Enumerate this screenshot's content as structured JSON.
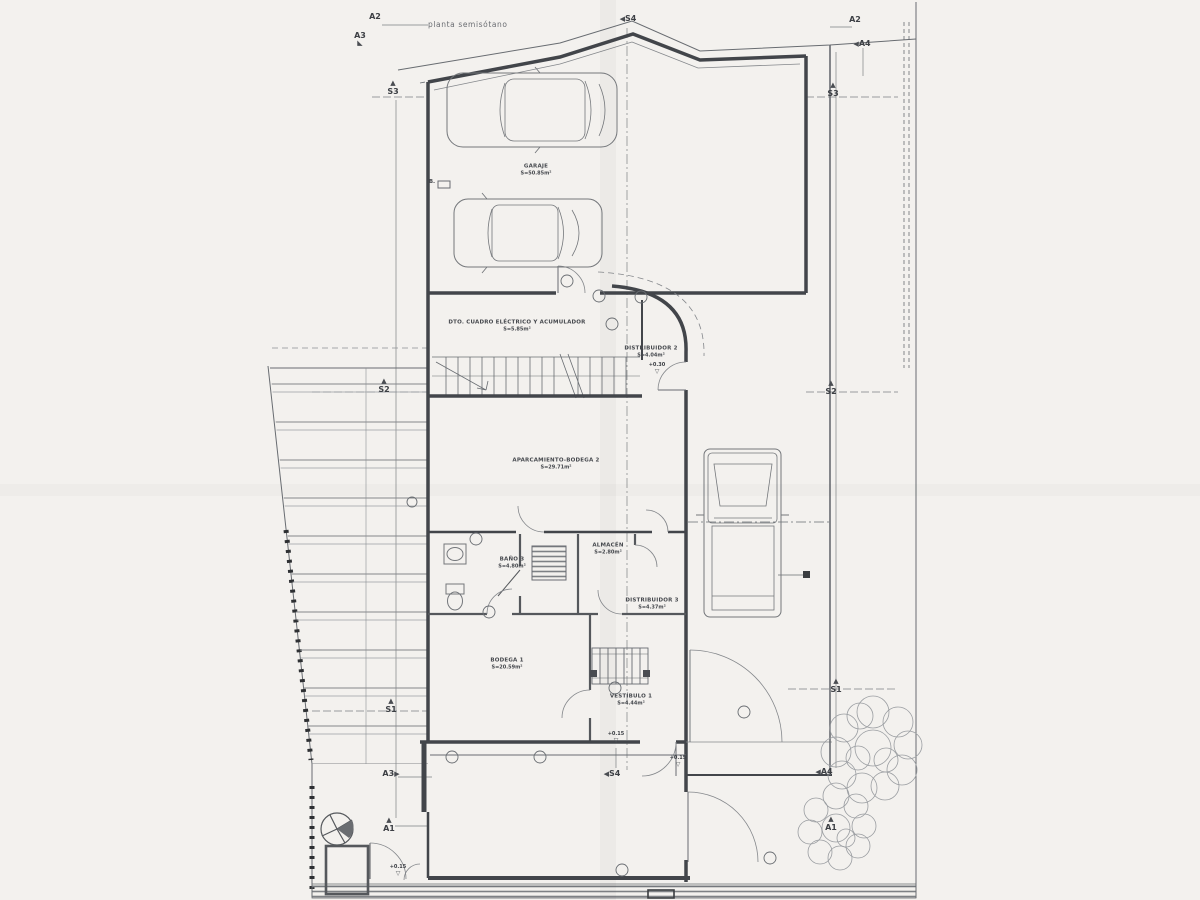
{
  "meta": {
    "title": "planta semisótano"
  },
  "colors": {
    "paper": "#f3f1ee",
    "line": "#686c71",
    "wall": "#42454a",
    "dark": "#2b2d30"
  },
  "rooms": [
    {
      "name": "GARAJE",
      "area": "S=50.85m²",
      "x": 536,
      "y": 170
    },
    {
      "name": "DTO. CUADRO ELÉCTRICO Y ACUMULADOR",
      "area": "S=5.85m²",
      "x": 517,
      "y": 326
    },
    {
      "name": "DISTRIBUIDOR 2",
      "area": "S=4.04m²",
      "x": 651,
      "y": 352
    },
    {
      "name": "APARCAMIENTO-BODEGA 2",
      "area": "S=29.71m²",
      "x": 556,
      "y": 464
    },
    {
      "name": "BAÑO 3",
      "area": "S=4.80m²",
      "x": 512,
      "y": 563
    },
    {
      "name": "ALMACÉN",
      "area": "S=2.80m²",
      "x": 608,
      "y": 549
    },
    {
      "name": "DISTRIBUIDOR 3",
      "area": "S=4.37m²",
      "x": 652,
      "y": 604
    },
    {
      "name": "BODEGA 1",
      "area": "S=20.59m²",
      "x": 507,
      "y": 664
    },
    {
      "name": "VESTÍBULO 1",
      "area": "S=4.44m²",
      "x": 631,
      "y": 700
    }
  ],
  "levels": [
    {
      "label": "+0.30",
      "x": 657,
      "y": 369
    },
    {
      "label": "+0.15",
      "x": 616,
      "y": 738
    },
    {
      "label": "+0.15",
      "x": 678,
      "y": 762
    },
    {
      "label": "+0.15",
      "x": 398,
      "y": 871
    }
  ],
  "markers": [
    {
      "label": "A2",
      "x": 375,
      "y": 17,
      "tri": "none"
    },
    {
      "label": "A3",
      "x": 360,
      "y": 40,
      "tri": "downleft"
    },
    {
      "label": "S3",
      "x": 393,
      "y": 88,
      "tri": "up"
    },
    {
      "label": "S4",
      "x": 628,
      "y": 19,
      "tri": "left"
    },
    {
      "label": "A2",
      "x": 855,
      "y": 20,
      "tri": "none"
    },
    {
      "label": "A4",
      "x": 862,
      "y": 44,
      "tri": "left"
    },
    {
      "label": "S3",
      "x": 833,
      "y": 90,
      "tri": "up"
    },
    {
      "label": "S2",
      "x": 384,
      "y": 386,
      "tri": "up"
    },
    {
      "label": "S2",
      "x": 831,
      "y": 388,
      "tri": "up"
    },
    {
      "label": "S1",
      "x": 391,
      "y": 706,
      "tri": "up"
    },
    {
      "label": "S1",
      "x": 836,
      "y": 686,
      "tri": "up"
    },
    {
      "label": "A3",
      "x": 391,
      "y": 774,
      "tri": "right"
    },
    {
      "label": "A4",
      "x": 824,
      "y": 772,
      "tri": "left"
    },
    {
      "label": "S4",
      "x": 612,
      "y": 774,
      "tri": "left"
    },
    {
      "label": "A1",
      "x": 389,
      "y": 825,
      "tri": "up"
    },
    {
      "label": "A1",
      "x": 831,
      "y": 824,
      "tri": "up"
    }
  ],
  "misc_labels": [
    {
      "label": "B.",
      "x": 432,
      "y": 182
    }
  ]
}
